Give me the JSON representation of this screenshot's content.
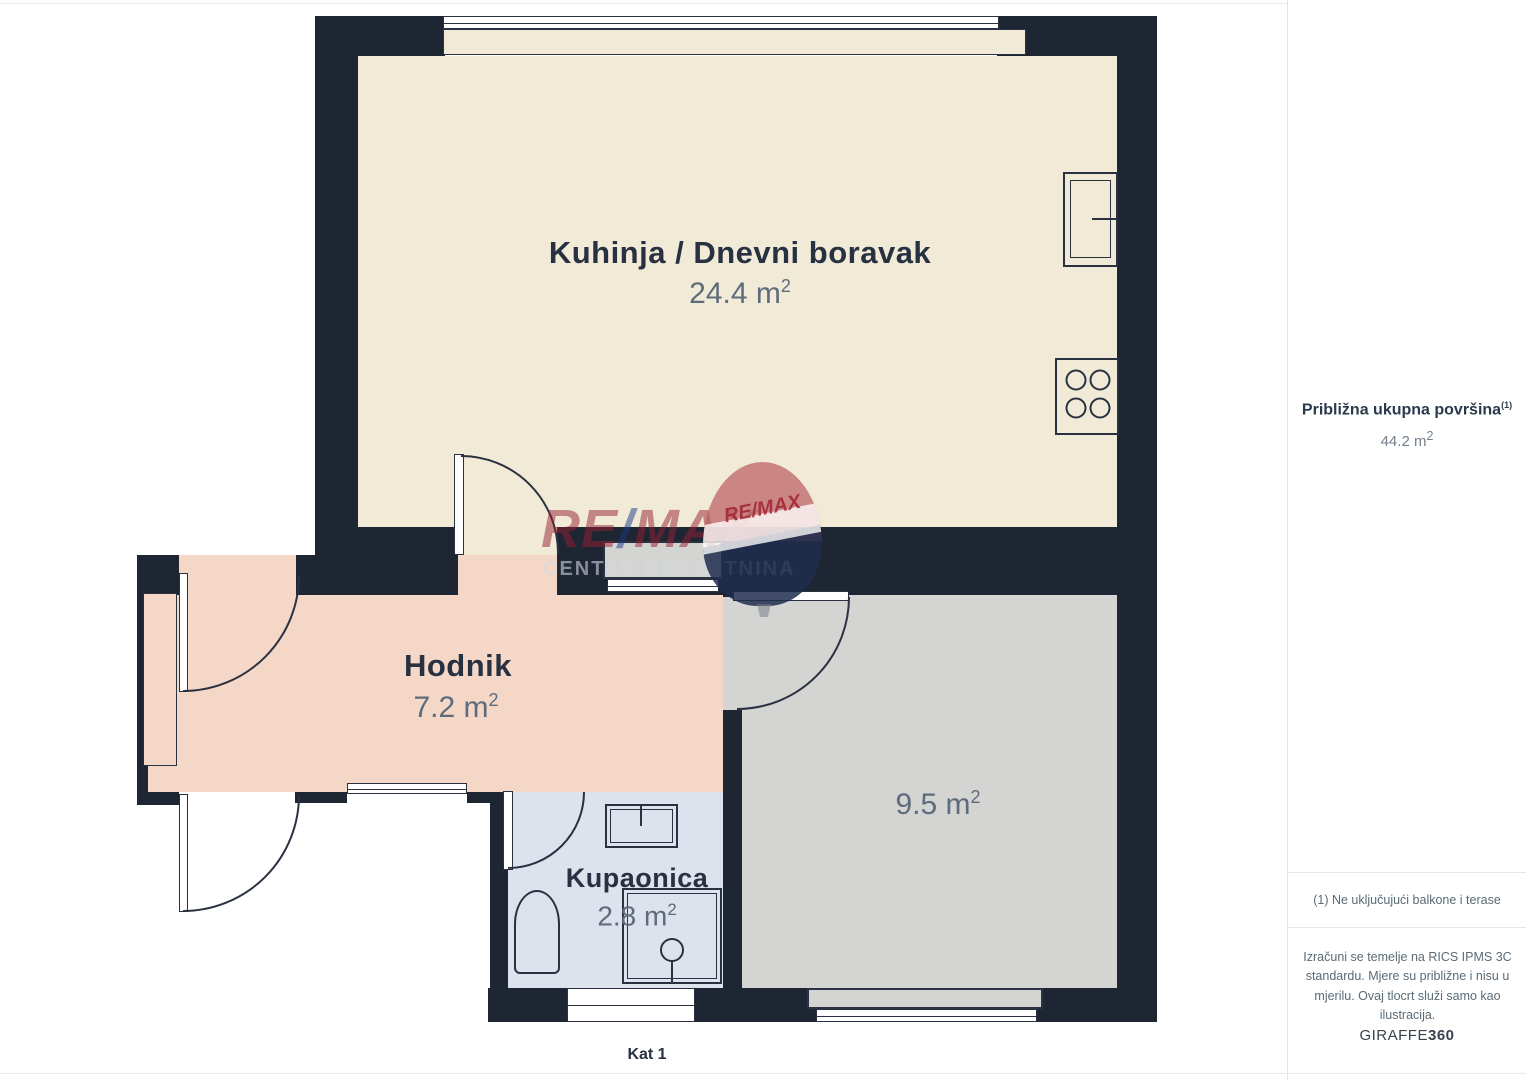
{
  "page": {
    "floor_label": "Kat 1"
  },
  "floorplan": {
    "rooms": [
      {
        "name": "Kuhinja / Dnevni boravak",
        "area": "24.4 m²"
      },
      {
        "name": "Hodnik",
        "area": "7.2 m²"
      },
      {
        "name": "Kupaonica",
        "area": "2.8 m²"
      },
      {
        "name": "",
        "area": "9.5 m²"
      }
    ]
  },
  "sidebar": {
    "total_label": "Približna ukupna površina",
    "total_footnote_ref": "(1)",
    "total_value": "44.2 m²",
    "footnote": "(1) Ne uključujući balkone i terase",
    "disclaimer": "Izračuni se temelje na RICS IPMS 3C standardu. Mjere su približne i nisu u mjerilu. Ovaj tlocrt služi samo kao ilustracija.",
    "brand_name": "GIRAFFE",
    "brand_suffix": "360"
  },
  "watermark": {
    "re": "RE",
    "slash": "/",
    "max": "MAX",
    "subtitle": "CENTAR NEKRETNINA",
    "balloon_label": "RE/MAX"
  },
  "colors": {
    "wall": "#1e2634",
    "kitchen_fill": "#f1ead7",
    "hallway_fill": "#f4d7c7",
    "bathroom_fill": "#dee2ec",
    "room_fill": "#d4d4d2",
    "accent_red": "#9e2c3c",
    "accent_blue": "#1d3f94"
  }
}
